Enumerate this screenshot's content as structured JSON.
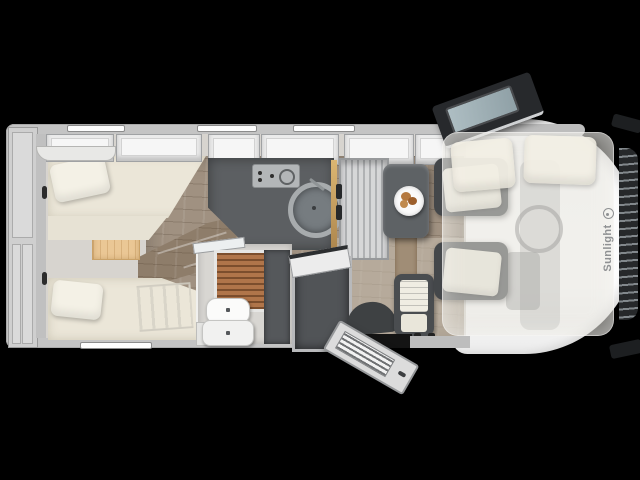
{
  "brand": {
    "name": "Sunlight",
    "logo_icon": "sun-circle-logo"
  },
  "image": {
    "kind": "motorhome-floorplan-top-view",
    "background": "#000000"
  },
  "colors": {
    "body_wall": "#c4c4c4",
    "cab_white": "#f5f5f5",
    "floor_wood": "#a09181",
    "steps_wood": "#8e7d6a",
    "bed_cream": "#ebe6d8",
    "counter_dark": "#5c5f62",
    "seat_dark": "#46494b",
    "wood_accent_panel": "#eac795",
    "gold_trim": "#c8a25f",
    "shower_slats": "#b0754a",
    "drop_down_bed_overlay": "rgba(230,229,220,0.52)",
    "windshield": "#26282a"
  },
  "fixtures": [
    "rear-storage-compartment",
    "overhead-cabinets",
    "twin-bed-top",
    "twin-bed-bottom",
    "bed-ladder",
    "bedroom-steps",
    "kitchen-counter",
    "stove",
    "round-sink",
    "tall-cabinet-fridge",
    "dinette-table",
    "food-plate",
    "bathroom",
    "shower-slats",
    "cassette-toilet",
    "wardrobe",
    "entry-door-open",
    "driver-door-open",
    "cab-seat-driver",
    "cab-seat-passenger",
    "drop-down-bed-overlay",
    "bed-pillows",
    "windshield",
    "side-mirrors",
    "wall-windows"
  ]
}
